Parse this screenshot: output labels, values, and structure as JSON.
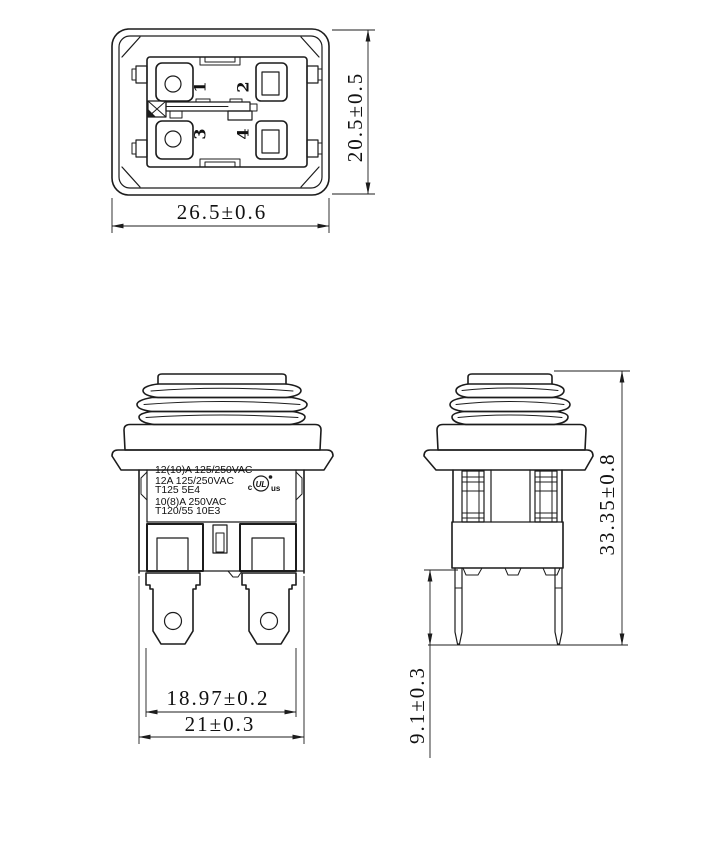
{
  "colors": {
    "background": "#ffffff",
    "line": "#1c1c1c"
  },
  "views": {
    "top": {
      "terminal_numbers": [
        "1",
        "2",
        "3",
        "4"
      ],
      "width_dim": "26.5±0.6",
      "height_dim": "20.5±0.5"
    },
    "front": {
      "marking_lines": [
        "12(10)A 125/250VAC",
        "12A 125/250VAC",
        "T125 5E4",
        "10(8)A 250VAC",
        "T120/55 10E3"
      ],
      "certification": {
        "prefix": "c",
        "logo": "UL",
        "suffix": "us"
      },
      "terminal_span_dim": "18.97±0.2",
      "body_width_dim": "21±0.3"
    },
    "side": {
      "total_height_dim": "33.35±0.8",
      "pin_length_dim": "9.1±0.3"
    }
  }
}
